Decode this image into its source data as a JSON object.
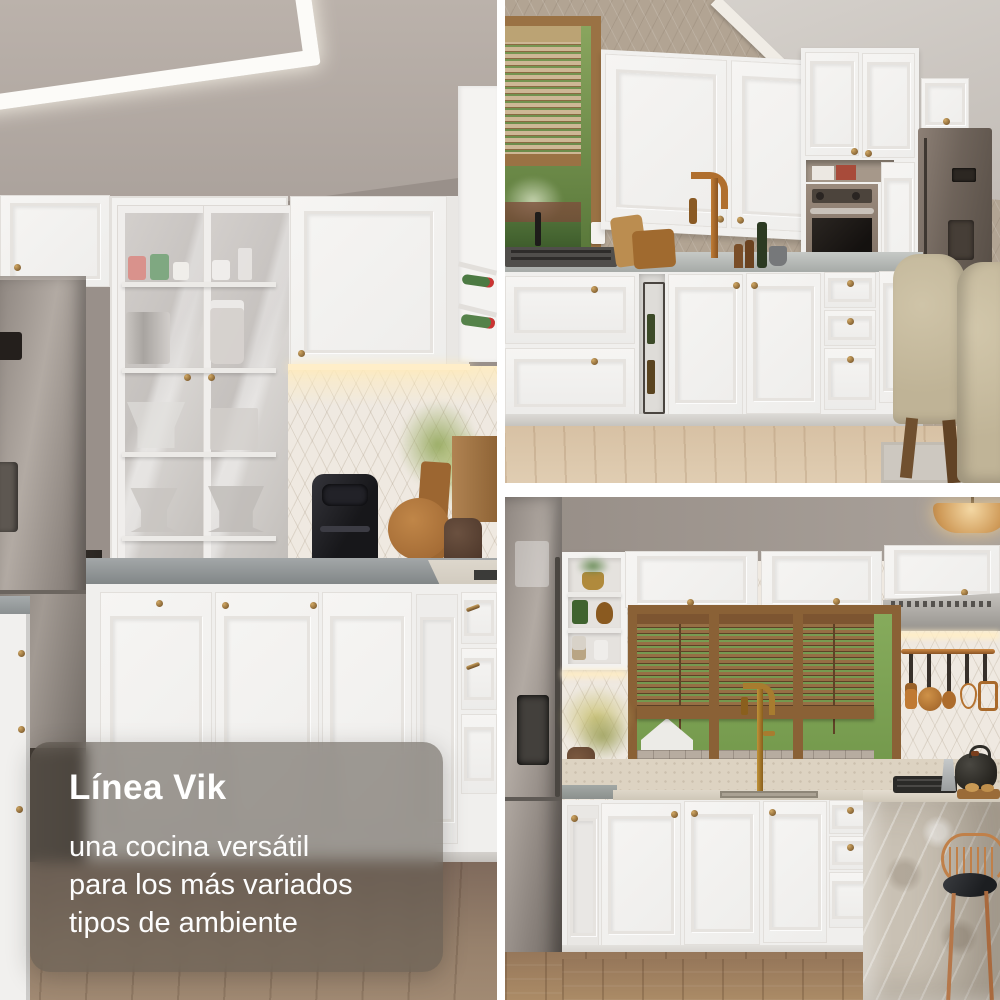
{
  "overlay": {
    "title": "Línea Vik",
    "lines": [
      "una cocina versátil",
      "para los más variados",
      "tipos de ambiente"
    ],
    "text_color": "#ffffff",
    "card_background": "rgba(95,88,80,0.58)"
  },
  "colors": {
    "divider": "#ffffff",
    "cabinet_white": "#f3f2f0",
    "brass_knob": "#8a6b3a",
    "copper_accent": "#b5722f",
    "counter_gray": "#8f9394",
    "wood_floor_left": "#8d7260",
    "wood_floor_pale": "#d9c3a6",
    "wood_floor_mid": "#9f8160",
    "wall_taupe": "#a59c95",
    "wall_beige": "#b2a493",
    "window_wood": "#8a6136"
  }
}
